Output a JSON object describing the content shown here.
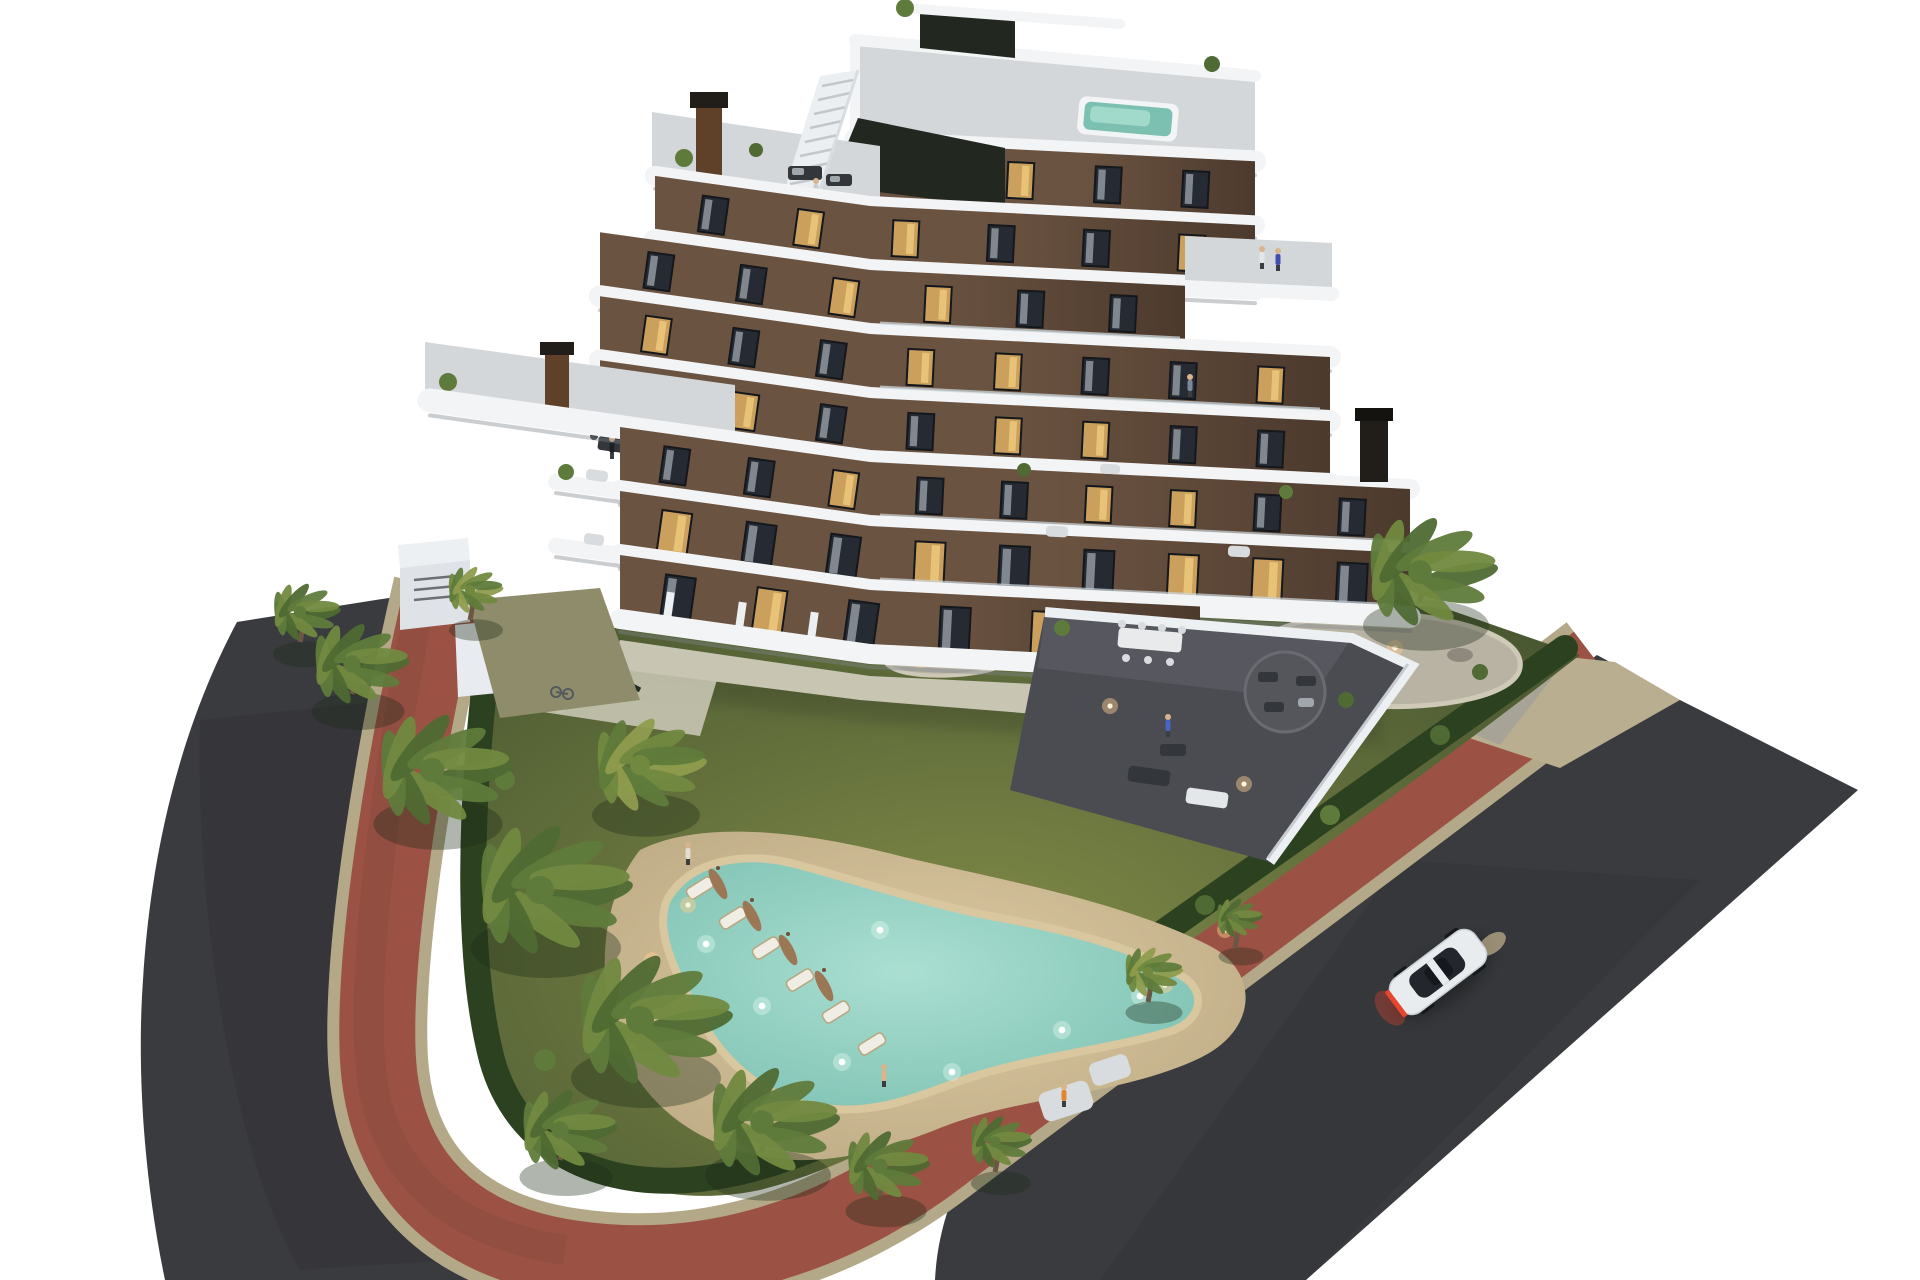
{
  "scene": {
    "type": "aerial 3d architectural render",
    "time_of_day": "dusk",
    "description": "Modern 7-storey apartment building with curved white balcony bands, rooftop plunge pool, landscaped garden with free-form lagoon pool, palm trees, red brick perimeter path, two asphalt streets and one white car",
    "building": {
      "floors": 7,
      "facade_style": "dark brown walls with curved white floor bands",
      "rooftop_pool": true,
      "rooftop_stairs": true,
      "chimneys": 3,
      "terraces": "wrap-around with glass balustrades"
    },
    "garden": {
      "pool_shape": "free-form lagoon",
      "pool_lit": true,
      "sun_loungers": 6,
      "closed_umbrellas": 4,
      "palm_trees": 14,
      "rock_islands": 2,
      "hedge_perimeter": true
    },
    "streets": {
      "left": "asphalt road",
      "right": "asphalt road",
      "sidewalk": "red brick path with tan curbs"
    },
    "vehicles": [
      {
        "type": "car",
        "color": "white",
        "taillights": "on",
        "location": "right road"
      }
    ],
    "people_count": 10
  },
  "palette": {
    "background": "#ffffff",
    "asphalt": "#3a3b3f",
    "asphalt_dark": "#313236",
    "brick_red": "#9b5244",
    "brick_dark": "#8a4a3e",
    "curb_tan": "#b3a887",
    "apron_beige": "#b9ae8f",
    "gravel_gray": "#a7a396",
    "grass_light": "#7f8a47",
    "grass_dark": "#475530",
    "hedge": "#2c4120",
    "palm_dark": "#4f6a33",
    "palm_mid": "#5f7b3b",
    "palm_light": "#71893f",
    "palm_yellow": "#8f9c4d",
    "trunk": "#6b5744",
    "sand_deck": "#cfbd98",
    "sand_dark": "#b7a57f",
    "pool_center": "#aadfd2",
    "pool_edge": "#7cc0b1",
    "pool_rim": "#d8c79f",
    "white_band": "#f3f4f6",
    "band_shadow": "#7d858c",
    "facade_light": "#6b5341",
    "facade_dark": "#4c3a2d",
    "window_frame": "#14171b",
    "window_glass": "#262b33",
    "window_lit": "#caa05c",
    "window_lit_hi": "#e8c276",
    "curtain": "#9fa7ad",
    "roof_deck": "#d4d7da",
    "terrace_tile": "#4b4c52",
    "terrace_tile_light": "#585961",
    "paved": "#c8c5b2",
    "courtyard_olive": "#8f8c6b",
    "wall_white": "#edf0f2",
    "chimney_rust": "#5e4128",
    "chimney_dark": "#211d18",
    "recess_dark": "#222820",
    "shadow": "#23281e",
    "car_body": "#e9ecee",
    "car_glass": "#23262c",
    "car_roof": "#15181d",
    "taillight": "#e8452f",
    "headlight_glow": "#ffe6b4",
    "lamp_glow": "#ffcf8e",
    "lamp_core": "#fff3d8",
    "skin": "#d9b48f",
    "umbrella_brown": "#9b7756",
    "rock_bed": "#b9b3a4",
    "rock": "#8e897c",
    "furniture_dark": "#33363b",
    "furniture_light": "#d8dcdf"
  }
}
